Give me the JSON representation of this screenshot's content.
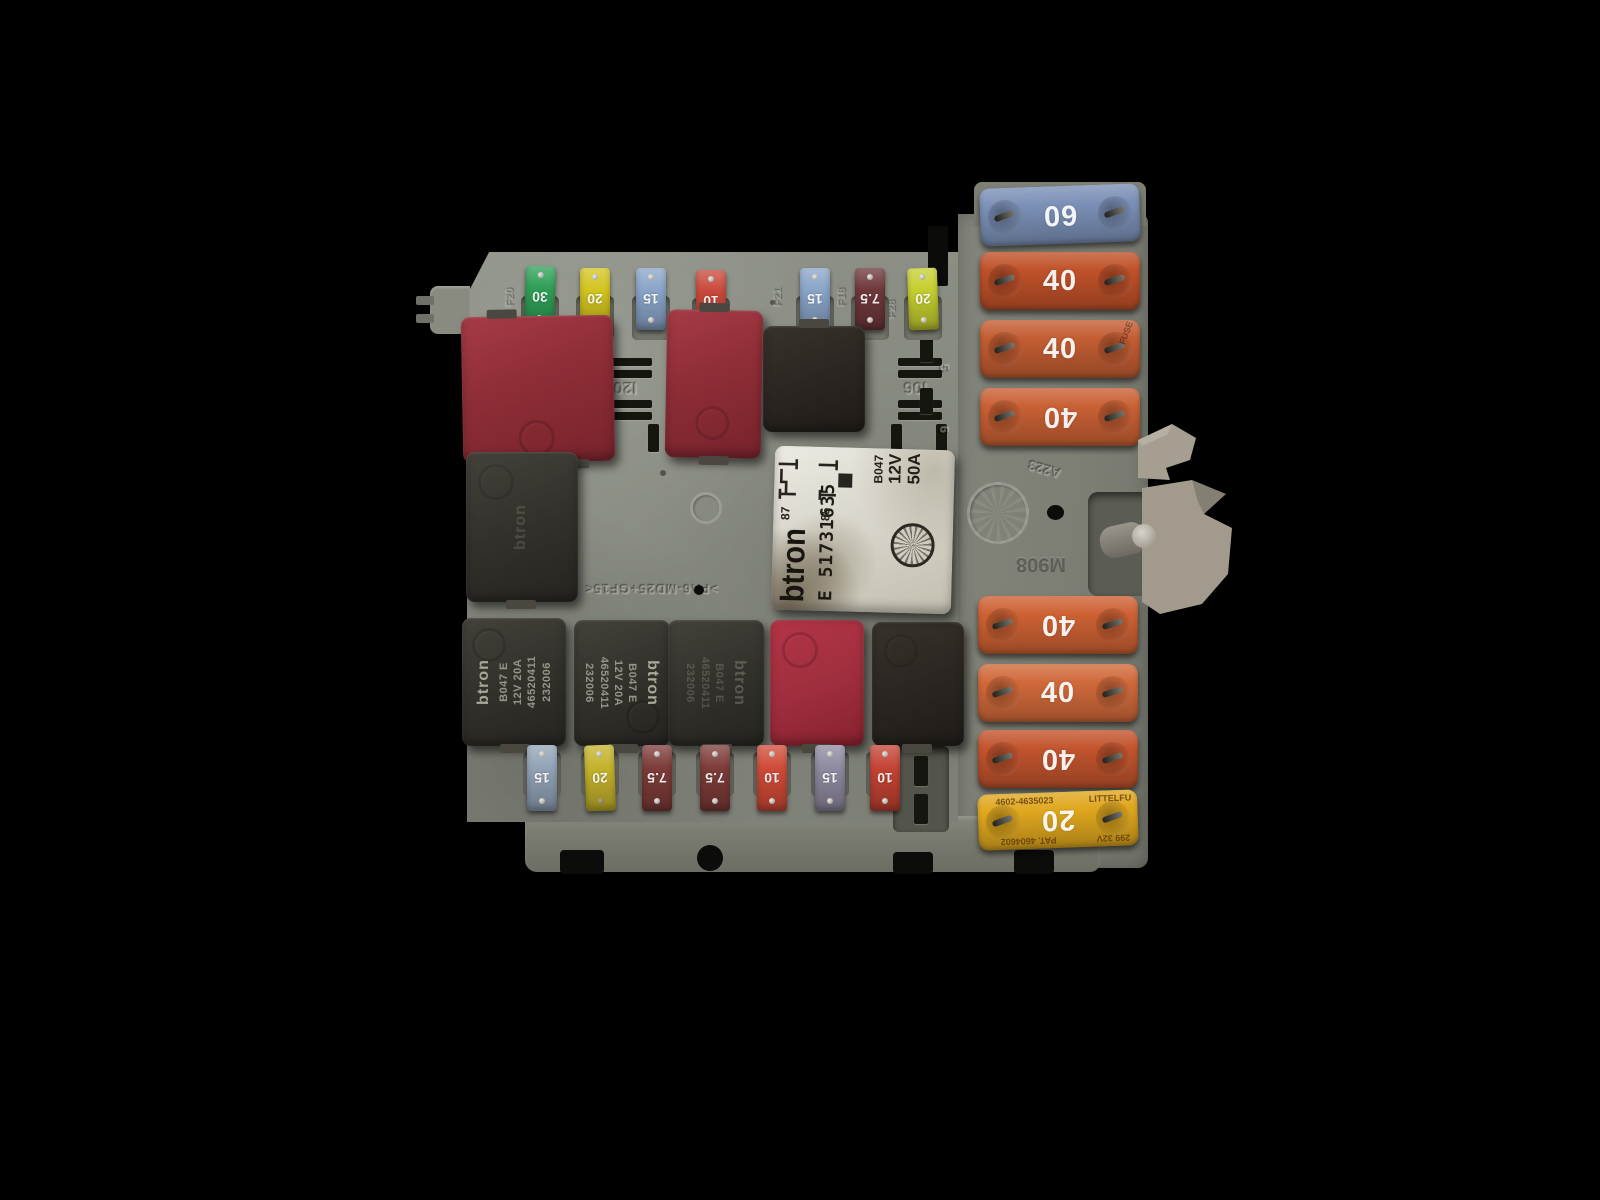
{
  "mini_fuses_top": [
    {
      "amps": "30",
      "code": "F20",
      "color": "#2fa057"
    },
    {
      "amps": "20",
      "code": "",
      "color": "#d3c41f"
    },
    {
      "amps": "15",
      "code": "",
      "color": "#8aa5c9"
    },
    {
      "amps": "10",
      "code": "",
      "color": "#c8483a"
    },
    {
      "amps": "15",
      "code": "F21",
      "color": "#8aa5c9"
    },
    {
      "amps": "7.5",
      "code": "F18",
      "color": "#6f383b"
    },
    {
      "amps": "20",
      "code": "F28",
      "color": "#c6cf2e"
    }
  ],
  "mini_fuses_bottom": [
    {
      "amps": "15",
      "color": "#92a3b7"
    },
    {
      "amps": "20",
      "color": "#c4b22a"
    },
    {
      "amps": "7.5",
      "color": "#7d3c39"
    },
    {
      "amps": "7.5",
      "color": "#7d3c39"
    },
    {
      "amps": "10",
      "color": "#d14b38"
    },
    {
      "amps": "15",
      "color": "#8f8aa0"
    },
    {
      "amps": "10",
      "color": "#c44334"
    }
  ],
  "maxi_fuses_top": [
    {
      "amps": "60",
      "color": "#7b90b6"
    },
    {
      "amps": "40",
      "color": "#bf5129"
    },
    {
      "amps": "40",
      "color": "#c35d32",
      "side_text": "FUSE"
    },
    {
      "amps": "40",
      "color": "#c96034"
    }
  ],
  "maxi_fuses_bottom": [
    {
      "amps": "40",
      "color": "#cd6133"
    },
    {
      "amps": "40",
      "color": "#d0693a"
    },
    {
      "amps": "40",
      "color": "#c2542d"
    },
    {
      "amps": "20",
      "color": "#dfa71e",
      "markings": {
        "top_left": "4602-4635023",
        "top_right": "LITTELFU",
        "bottom_left": "PAT. 4604602",
        "bottom_right": "299 32V"
      }
    }
  ],
  "main_relay": {
    "brand": "btron",
    "part_number": "E 51731635",
    "pin_labels": [
      "87",
      "85"
    ],
    "rating_lines": [
      "B047",
      "12V",
      "50A"
    ]
  },
  "aux_relay": {
    "brand": "btron",
    "lines": [
      "B047 E",
      "12V 20A",
      "46520411",
      "232006"
    ]
  },
  "board_markings": {
    "socket_left": "I20",
    "socket_right": "I06",
    "material_code": ">PA6-MD25+GF15<",
    "mold_code_a": "A223",
    "mold_code_b": "M908",
    "digit_upper": "5",
    "digit_lower": "6"
  }
}
